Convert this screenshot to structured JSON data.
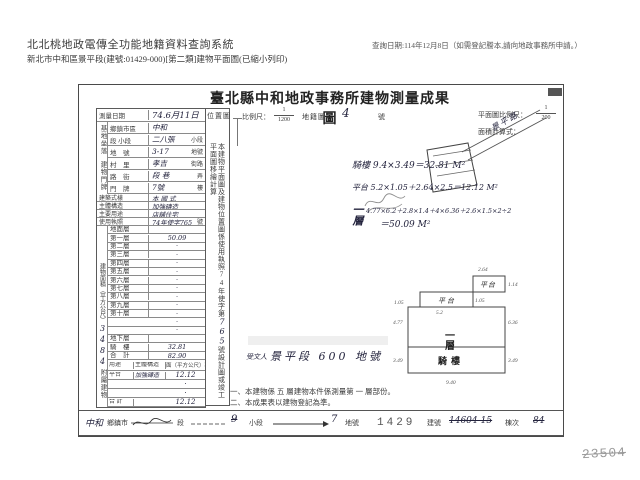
{
  "page": {
    "sys_title": "北北桃地政電傳全功能地籍資料查詢系統",
    "sub_title": "新北市中和區景平段(建號:01429-000)[第二類]建物平面圖(已縮小列印)",
    "query_date": "查詢日期:114年12月8日（如需登記謄本,請向地政事務所申請。）"
  },
  "form": {
    "title": "臺北縣中和地政事務所建物測量成果圖",
    "survey": {
      "label": "測量日期",
      "value": "74.6月11日"
    },
    "scale_bar": {
      "loc_label": "位置圖",
      "ratio_label": "比例尺：",
      "num": "1",
      "den": "1200",
      "map_label": "地籍圖",
      "sheet": "4",
      "sheet_unit": "號",
      "plan_label": "平面圖比例尺：",
      "plan_num": "1",
      "plan_den": "200",
      "calc_label": "面積計算式："
    },
    "site": {
      "group": "基地坐落",
      "rows": [
        {
          "label": "鄉鎮市區",
          "value": "中和",
          "suffix": ""
        },
        {
          "label": "段 小段",
          "value": "二八張",
          "suffix": "小段"
        },
        {
          "label": "地　號",
          "value": "3-17",
          "suffix": "地號"
        }
      ]
    },
    "door": {
      "group": "建物門牌",
      "rows": [
        {
          "label": "村　里",
          "value": "孝吉",
          "suffix": "街路"
        },
        {
          "label": "路　街",
          "value": "段 巷",
          "suffix": "弄"
        },
        {
          "label": "門　牌",
          "value": "7號",
          "suffix": "樓"
        }
      ]
    },
    "attrs": {
      "rows": [
        {
          "label": "建築式樣",
          "value": "本 國 式",
          "suffix": ""
        },
        {
          "label": "主體構造",
          "value": "加強磚造",
          "suffix": ""
        },
        {
          "label": "主要用途",
          "value": "店舖住宅",
          "suffix": ""
        },
        {
          "label": "使用執照",
          "value": "74年使字765",
          "suffix": "號"
        }
      ]
    },
    "floor_area": {
      "group": "建物面積（平方公尺）",
      "margin_note": "3484",
      "rows": [
        {
          "label": "地面層",
          "value": ""
        },
        {
          "label": "第一層",
          "value": "50.09"
        },
        {
          "label": "第二層",
          "value": "·"
        },
        {
          "label": "第三層",
          "value": "·"
        },
        {
          "label": "第四層",
          "value": "·"
        },
        {
          "label": "第五層",
          "value": "·"
        },
        {
          "label": "第六層",
          "value": "·"
        },
        {
          "label": "第七層",
          "value": "·"
        },
        {
          "label": "第八層",
          "value": "·"
        },
        {
          "label": "第九層",
          "value": "·"
        },
        {
          "label": "第十層",
          "value": "·"
        },
        {
          "label": "",
          "value": "·"
        },
        {
          "label": "",
          "value": "·"
        },
        {
          "label": "地下層",
          "value": ""
        },
        {
          "label": "騎　樓",
          "value": "32.81"
        },
        {
          "label": "合　計",
          "value": "82.90"
        }
      ]
    },
    "annex": {
      "group": "附屬建物",
      "headers": {
        "use": "用途",
        "structure": "主體構造",
        "area": "面（平方公尺）積"
      },
      "rows": [
        {
          "use": "平台",
          "structure": "加強磚造",
          "area": "12.12"
        },
        {
          "use": "",
          "structure": "",
          "area": "·"
        },
        {
          "use": "",
          "structure": "",
          "area": "·"
        },
        {
          "use": "合 計",
          "structure": "",
          "area": "12.12"
        }
      ]
    },
    "side_note": {
      "pre": "本建物平面圖及建物位置圖係使用執照74年使字第",
      "hw": "765",
      "post": "號設計圖或竣工平面圖移繪計算"
    },
    "sketch": {
      "street": "景平路"
    },
    "calc": {
      "line1": "騎樓 9.4×3.49＝32.81 M²",
      "line2": "平台 5.2×1.05＋2.64×2.5＝12.12 M²",
      "line3_label": "一層",
      "line3": "4.77×6.2＋2.8×1.4＋4×6.36＋2.6×1.5×2÷2",
      "line3_result": "＝50.09 M²"
    },
    "site_note": {
      "prefix": "受文人",
      "text": "景平段 600 地號"
    },
    "plan": {
      "platform_a": "平台",
      "platform_b": "平台",
      "floor": "一層",
      "arcade": "騎樓",
      "dims": {
        "pa_left": "1.05",
        "pa_bottom": "5.2",
        "pa_right": "1.05",
        "pb_top": "2.64",
        "pb_right": "1.14",
        "floor_left": "4.77",
        "floor_right": "6.36",
        "arcade_left": "3.49",
        "arcade_right": "3.49",
        "bottom": "9.40"
      }
    },
    "notes": [
      "一、本建物係 五 層建物本件係測量第 一 層部份。",
      "二、本成果表以建物登記為準。"
    ],
    "footer": {
      "town_hw": "中和",
      "town": "鄉鎮市",
      "sec": "段",
      "sec_hw": "9",
      "subsec": "小段",
      "subsec_hw": "7",
      "parcel": "地號",
      "parcel_no": "1429",
      "bldg": "建號",
      "bldg_hw": "14604-15",
      "unit": "棟次",
      "unit_hw": "84"
    },
    "corner_no": "23504"
  }
}
